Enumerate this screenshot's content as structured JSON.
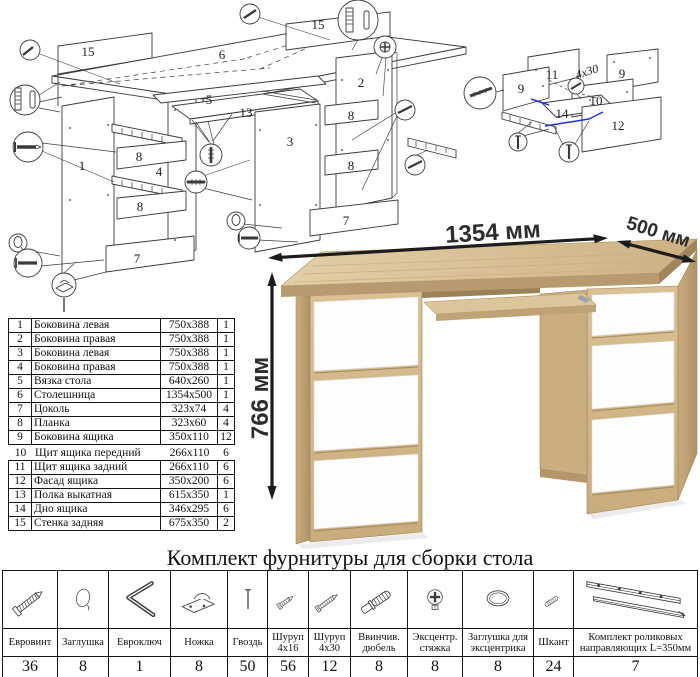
{
  "diagrams": {
    "main": {
      "labels": [
        "15",
        "6",
        "15",
        "2",
        "5",
        "13",
        "1",
        "8",
        "4",
        "8",
        "3",
        "8",
        "8",
        "7",
        "7"
      ]
    },
    "drawer": {
      "labels": [
        "11",
        "9",
        "9",
        "10",
        "14",
        "12"
      ],
      "screw_note": "4х30"
    }
  },
  "render": {
    "width_label": "1354 мм",
    "depth_label": "500 мм",
    "height_label": "766 мм",
    "colors": {
      "oak": "#d3b789",
      "oak_dark": "#b0946a",
      "drawer_white": "#fdfdfd"
    }
  },
  "parts_table": {
    "rows": [
      {
        "num": "1",
        "name": "Боковина левая",
        "size": "750x388",
        "qty": "1"
      },
      {
        "num": "2",
        "name": "Боковина правая",
        "size": "750x388",
        "qty": "1"
      },
      {
        "num": "3",
        "name": "Боковина левая",
        "size": "750x388",
        "qty": "1"
      },
      {
        "num": "4",
        "name": "Боковина правая",
        "size": "750x388",
        "qty": "1"
      },
      {
        "num": "5",
        "name": "Вязка стола",
        "size": "640x260",
        "qty": "1"
      },
      {
        "num": "6",
        "name": "Столешница",
        "size": "1354x500",
        "qty": "1"
      },
      {
        "num": "7",
        "name": "Цоколь",
        "size": "323x74",
        "qty": "4"
      },
      {
        "num": "8",
        "name": "Планка",
        "size": "323x60",
        "qty": "4"
      },
      {
        "num": "9",
        "name": "Боковина ящика",
        "size": "350x110",
        "qty": "12"
      },
      {
        "num": "10",
        "name": "Щит ящика передний",
        "size": "266x110",
        "qty": "6"
      },
      {
        "num": "11",
        "name": "Щит ящика задний",
        "size": "266x110",
        "qty": "6"
      },
      {
        "num": "12",
        "name": "Фасад ящика",
        "size": "350x200",
        "qty": "6"
      },
      {
        "num": "13",
        "name": "Полка выкатная",
        "size": "615x350",
        "qty": "1"
      },
      {
        "num": "14",
        "name": "Дно ящика",
        "size": "346x295",
        "qty": "6"
      },
      {
        "num": "15",
        "name": "Стенка задняя",
        "size": "675x350",
        "qty": "2"
      }
    ]
  },
  "hardware": {
    "title": "Комплект фурнитуры для сборки стола",
    "items": [
      {
        "name": "Евровинт",
        "qty": "36",
        "icon": "euro-screw-icon"
      },
      {
        "name": "Заглушка",
        "qty": "8",
        "icon": "plug-icon"
      },
      {
        "name": "Евроключ",
        "qty": "1",
        "icon": "hex-key-icon"
      },
      {
        "name": "Ножка",
        "qty": "8",
        "icon": "foot-icon"
      },
      {
        "name": "Гвоздь",
        "qty": "50",
        "icon": "nail-icon"
      },
      {
        "name": "Шуруп 4x16",
        "qty": "56",
        "icon": "screw-4x16-icon"
      },
      {
        "name": "Шуруп 4x30",
        "qty": "12",
        "icon": "screw-4x30-icon"
      },
      {
        "name": "Ввинчив. дюбель",
        "qty": "8",
        "icon": "screw-dowel-icon"
      },
      {
        "name": "Эксцентр. стяжка",
        "qty": "8",
        "icon": "cam-lock-icon"
      },
      {
        "name": "Заглушка для эксцентрика",
        "qty": "8",
        "icon": "cam-cover-icon"
      },
      {
        "name": "Шкант",
        "qty": "24",
        "icon": "dowel-pin-icon"
      },
      {
        "name": "Комплект роликовых направляющих L=350мм",
        "qty": "7",
        "icon": "drawer-slides-icon"
      }
    ]
  }
}
